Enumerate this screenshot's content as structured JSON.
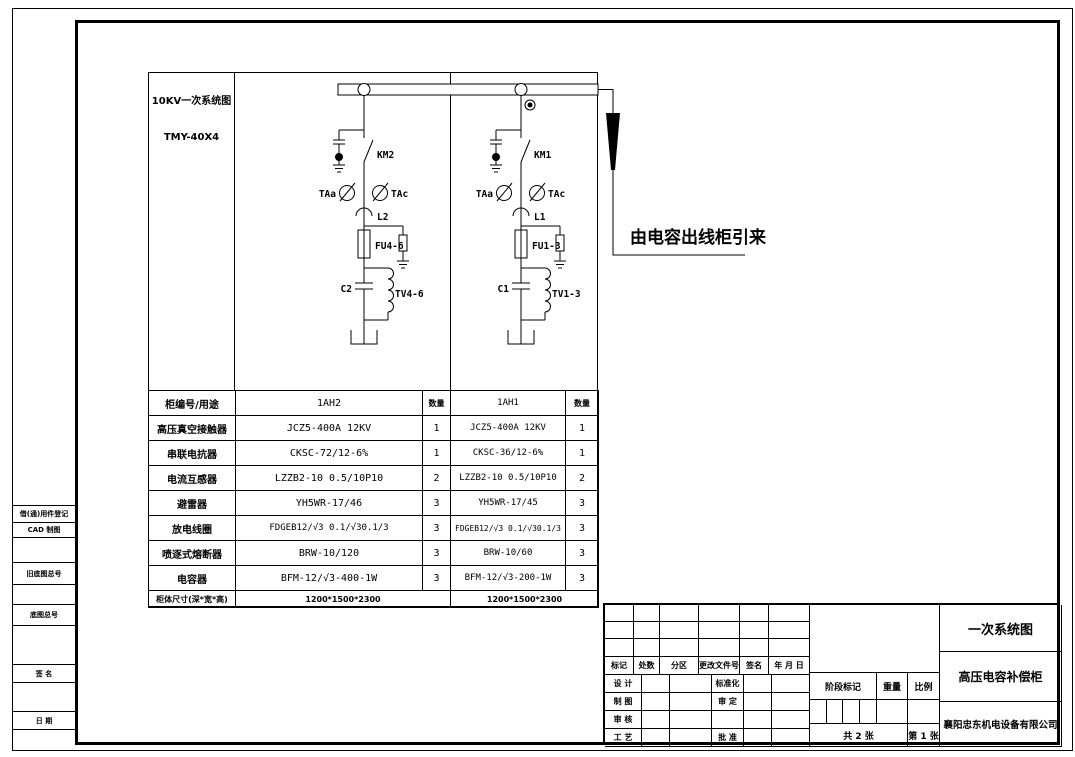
{
  "drawing": {
    "left_panel": {
      "title": "10KV一次系统图",
      "busbar_model": "TMY-40X4"
    },
    "incoming_note": "由电容出线柜引来",
    "bay_1ah2": {
      "contactor": "KM2",
      "ct_a": "TAa",
      "ct_c": "TAc",
      "reactor": "L2",
      "fuse": "FU4-6",
      "capacitor": "C2",
      "discharge_coil": "TV4-6"
    },
    "bay_1ah1": {
      "contactor": "KM1",
      "ct_a": "TAa",
      "ct_c": "TAc",
      "reactor": "L1",
      "fuse": "FU1-3",
      "capacitor": "C1",
      "discharge_coil": "TV1-3"
    }
  },
  "table": {
    "header": {
      "label": "柜编号/用途",
      "bay2": "1AH2",
      "qty": "数量",
      "bay1": "1AH1",
      "qty2": "数量"
    },
    "rows": [
      {
        "label": "高压真空接触器",
        "spec_1ah2": "JCZ5-400A 12KV",
        "qty_1ah2": "1",
        "spec_1ah1": "JCZ5-400A 12KV",
        "qty_1ah1": "1"
      },
      {
        "label": "串联电抗器",
        "spec_1ah2": "CKSC-72/12-6%",
        "qty_1ah2": "1",
        "spec_1ah1": "CKSC-36/12-6%",
        "qty_1ah1": "1"
      },
      {
        "label": "电流互感器",
        "spec_1ah2": "LZZB2-10 0.5/10P10",
        "qty_1ah2": "2",
        "spec_1ah1": "LZZB2-10 0.5/10P10",
        "qty_1ah1": "2"
      },
      {
        "label": "避雷器",
        "spec_1ah2": "YH5WR-17/46",
        "qty_1ah2": "3",
        "spec_1ah1": "YH5WR-17/45",
        "qty_1ah1": "3"
      },
      {
        "label": "放电线圈",
        "spec_1ah2": "FDGEB12/√3 0.1/√30.1/3",
        "qty_1ah2": "3",
        "spec_1ah1": "FDGEB12/√3 0.1/√30.1/3",
        "qty_1ah1": "3"
      },
      {
        "label": "喷逐式熔断器",
        "spec_1ah2": "BRW-10/120",
        "qty_1ah2": "3",
        "spec_1ah1": "BRW-10/60",
        "qty_1ah1": "3"
      },
      {
        "label": "电容器",
        "spec_1ah2": "BFM-12/√3-400-1W",
        "qty_1ah2": "3",
        "spec_1ah1": "BFM-12/√3-200-1W",
        "qty_1ah1": "3"
      }
    ],
    "footer": {
      "label": "柜体尺寸(深*宽*高)",
      "dim_1ah2": "1200*1500*2300",
      "dim_1ah1": "1200*1500*2300"
    }
  },
  "margin_labels": {
    "borrow_record": "借(通)用件登记",
    "cad_draft": "CAD 制图",
    "old_base_no": "旧底图总号",
    "base_no": "底图总号",
    "signature": "签 名",
    "date": "日 期"
  },
  "title_block": {
    "revision_header": {
      "mark": "标记",
      "count": "处数",
      "zone": "分区",
      "change_doc_no": "更改文件号",
      "sign": "签名",
      "date": "年 月 日"
    },
    "roles": {
      "design": "设 计",
      "draft": "制 图",
      "check": "审 核",
      "process": "工 艺",
      "standardization": "标准化",
      "examine": "审 定",
      "approve": "批 准"
    },
    "stage_mark": "阶段标记",
    "weight": "重量",
    "scale": "比例",
    "sheet_total": "共 2 张",
    "sheet_no": "第 1 张",
    "doc_title": "一次系统图",
    "product_name": "高压电容补偿柜",
    "company": "襄阳忠东机电设备有限公司"
  }
}
